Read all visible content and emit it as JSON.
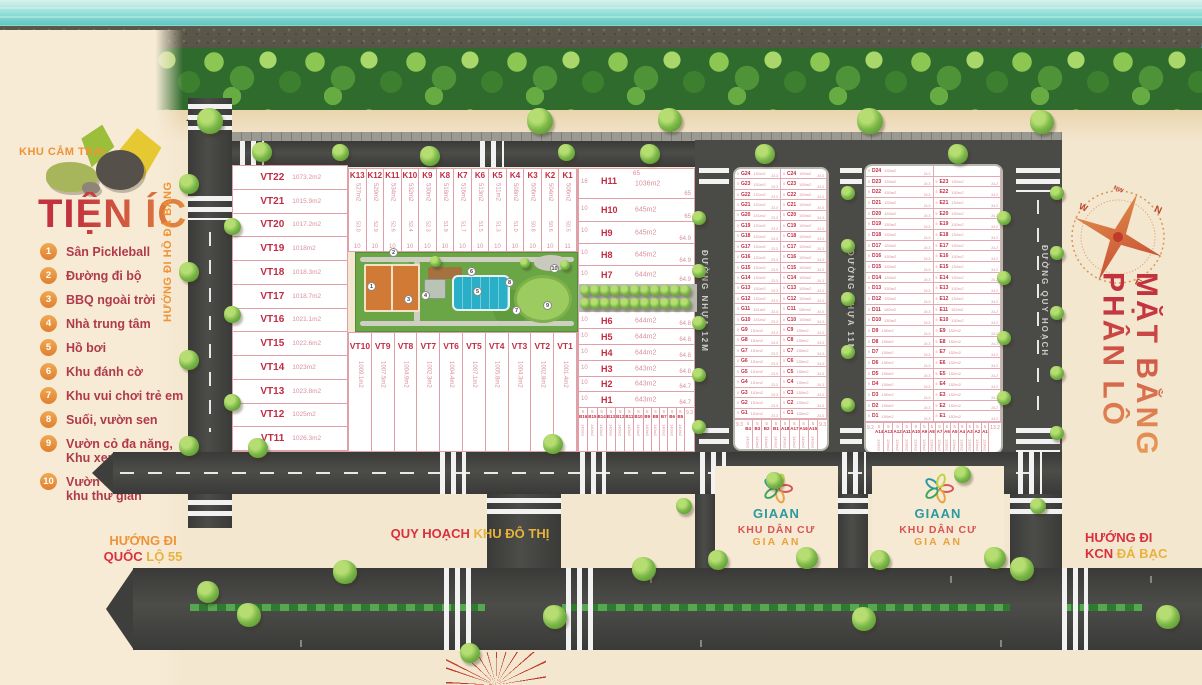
{
  "legend": {
    "camp": "KHU CẮM TRẠI",
    "heading": "TIỆN ÍCH",
    "items": [
      {
        "n": "1",
        "t": "Sân Pickleball"
      },
      {
        "n": "2",
        "t": "Đường đi bộ"
      },
      {
        "n": "3",
        "t": "BBQ ngoài trời"
      },
      {
        "n": "4",
        "t": "Nhà trung tâm"
      },
      {
        "n": "5",
        "t": "Hồ bơi"
      },
      {
        "n": "6",
        "t": "Khu đánh cờ"
      },
      {
        "n": "7",
        "t": "Khu vui chơi trẻ em"
      },
      {
        "n": "8",
        "t": "Suối, vườn sen"
      },
      {
        "n": "9",
        "t": "Vườn cỏ đa năng,\nKhu xem phim"
      },
      {
        "n": "10",
        "t": "Vườn cây ăn trái,\nkhu thư giãn"
      }
    ]
  },
  "title": {
    "line1": "MẶT BẰNG",
    "line2": "PHÂN LÔ"
  },
  "compass": {
    "n": "N",
    "nw": "NW",
    "w": "W",
    "e": "E"
  },
  "directions": {
    "ho_da_bang": "HƯỚNG ĐI HỒ ĐÁ BÀNG",
    "quoc_lo_1": "HƯỚNG ĐI",
    "quoc_lo_2a": "QUỐC",
    "quoc_lo_2b": "LỘ 55",
    "kcn_1": "HƯỚNG ĐI",
    "kcn_2a": "KCN",
    "kcn_2b": "ĐÁ BẠC",
    "khu_do_thi_a": "QUY HOẠCH",
    "khu_do_thi_b": "KHU ĐÔ THỊ"
  },
  "roads": {
    "nhua12": "ĐƯỜNG NHỰA 12M",
    "nhua11": "ĐƯỜNG NHỰA 11M",
    "quy_hoach": "ĐƯỜNG QUY HOẠCH"
  },
  "gia_an": {
    "brand": "GIAAN",
    "sub": "KHU DÂN CƯ",
    "name": "GIA AN"
  },
  "vt_left": [
    {
      "id": "VT22",
      "area": "1073.2m2"
    },
    {
      "id": "VT21",
      "area": "1015.9m2"
    },
    {
      "id": "VT20",
      "area": "1017.2m2"
    },
    {
      "id": "VT19",
      "area": "1018m2"
    },
    {
      "id": "VT18",
      "area": "1018.3m2"
    },
    {
      "id": "VT17",
      "area": "1018.7m2"
    },
    {
      "id": "VT16",
      "area": "1021.1m2"
    },
    {
      "id": "VT15",
      "area": "1022.6m2"
    },
    {
      "id": "VT14",
      "area": "1023m2"
    },
    {
      "id": "VT13",
      "area": "1023.8m2"
    },
    {
      "id": "VT12",
      "area": "1025m2"
    },
    {
      "id": "VT11",
      "area": "1026.3m2"
    }
  ],
  "k_row": [
    {
      "id": "K13",
      "area": "527m2",
      "len": "53.0",
      "w": "10"
    },
    {
      "id": "K12",
      "area": "529m2",
      "len": "52.9",
      "w": "10"
    },
    {
      "id": "K11",
      "area": "534m2",
      "len": "52.6",
      "w": "10"
    },
    {
      "id": "K10",
      "area": "532m2",
      "len": "52.4",
      "w": "10"
    },
    {
      "id": "K9",
      "area": "530m2",
      "len": "52.3",
      "w": "10"
    },
    {
      "id": "K8",
      "area": "518m2",
      "len": "51.9",
      "w": "10"
    },
    {
      "id": "K7",
      "area": "516m2",
      "len": "51.7",
      "w": "10"
    },
    {
      "id": "K6",
      "area": "513m2",
      "len": "51.5",
      "w": "10"
    },
    {
      "id": "K5",
      "area": "511m2",
      "len": "51.3",
      "w": "10"
    },
    {
      "id": "K4",
      "area": "508m2",
      "len": "51.0",
      "w": "10"
    },
    {
      "id": "K3",
      "area": "506m2",
      "len": "50.8",
      "w": "10"
    },
    {
      "id": "K2",
      "area": "504m2",
      "len": "50.6",
      "w": "10"
    },
    {
      "id": "K1",
      "area": "506m2",
      "len": "50.5",
      "w": "11"
    }
  ],
  "vt_bottom": [
    {
      "id": "VT10",
      "area": "1009.1m2"
    },
    {
      "id": "VT9",
      "area": "1007.5m2"
    },
    {
      "id": "VT8",
      "area": "1004.9m2"
    },
    {
      "id": "VT7",
      "area": "1002.3m2"
    },
    {
      "id": "VT6",
      "area": "1004.4m2"
    },
    {
      "id": "VT5",
      "area": "1007.1m2"
    },
    {
      "id": "VT4",
      "area": "1005.8m2"
    },
    {
      "id": "VT3",
      "area": "1004.3m2"
    },
    {
      "id": "VT2",
      "area": "1002.8m2"
    },
    {
      "id": "VT1",
      "area": "1001.4m2"
    }
  ],
  "h_block": {
    "top_len": "65",
    "rows": [
      {
        "id": "H11",
        "w": "16",
        "area": "1036m2",
        "len": "65"
      },
      {
        "id": "H10",
        "w": "10",
        "area": "645m2",
        "len": "65"
      },
      {
        "id": "H9",
        "w": "10",
        "area": "645m2",
        "len": "64.9"
      },
      {
        "id": "H8",
        "w": "10",
        "area": "645m2",
        "len": "64.9"
      },
      {
        "id": "H7",
        "w": "10",
        "area": "644m2",
        "len": "64.9"
      },
      {
        "id": "H6",
        "w": "10",
        "area": "644m2",
        "len": "64.8"
      },
      {
        "id": "H5",
        "w": "10",
        "area": "644m2",
        "len": "64.8"
      },
      {
        "id": "H4",
        "w": "10",
        "area": "644m2",
        "len": "64.8"
      },
      {
        "id": "H3",
        "w": "10",
        "area": "643m2",
        "len": "64.8"
      },
      {
        "id": "H2",
        "w": "10",
        "area": "643m2",
        "len": "64.7"
      },
      {
        "id": "H1",
        "w": "10",
        "area": "643m2",
        "len": "64.7"
      }
    ]
  },
  "b_row": {
    "right_edge": "9.3",
    "cells": [
      {
        "id": "B16",
        "w": "5",
        "area": "140m2"
      },
      {
        "id": "B15",
        "w": "5",
        "area": "140m2"
      },
      {
        "id": "B14",
        "w": "5",
        "area": "140m2"
      },
      {
        "id": "B13",
        "w": "5",
        "area": "140m2"
      },
      {
        "id": "B12",
        "w": "5",
        "area": "140m2"
      },
      {
        "id": "B11",
        "w": "5",
        "area": "140m2"
      },
      {
        "id": "B10",
        "w": "5",
        "area": "140m2"
      },
      {
        "id": "B9",
        "w": "5",
        "area": "140m2"
      },
      {
        "id": "B8",
        "w": "5",
        "area": "140m2"
      },
      {
        "id": "B7",
        "w": "5",
        "area": "140m2"
      },
      {
        "id": "B6",
        "w": "5",
        "area": "140m2"
      },
      {
        "id": "B5",
        "w": "5",
        "area": "140m2"
      }
    ]
  },
  "grid1": {
    "left": {
      "prefix": "G",
      "count": 24,
      "w": "5",
      "area": "151m2",
      "len": "23.3"
    },
    "right": {
      "prefix": "C",
      "count": 24,
      "w": "5",
      "area": "150m2",
      "len": "24.3"
    },
    "bottom": {
      "edge_l": "9.3",
      "edge_r": "9.3",
      "w": "5",
      "area": "140m2",
      "ids": [
        "B4",
        "B3",
        "B2",
        "B1",
        "A18",
        "A17",
        "A16",
        "A15"
      ]
    }
  },
  "grid2": {
    "left": {
      "prefix": "D",
      "count": 24,
      "w": "5",
      "area": "150m2",
      "len": "24.3"
    },
    "right": {
      "prefix": "E",
      "count": 23,
      "w": "5",
      "area": "152m2",
      "len": "24.2"
    },
    "bottom": {
      "edge_l": "9.2",
      "edge_r": "13.2",
      "w": "5",
      "area": "139m2",
      "ids": [
        "A14",
        "A13",
        "A12",
        "A11",
        "A10",
        "A9",
        "A8",
        "A7",
        "A6",
        "A5",
        "A4",
        "A3",
        "A2",
        "A1"
      ]
    }
  },
  "park_markers": [
    "1",
    "2",
    "3",
    "4",
    "5",
    "6",
    "7",
    "8",
    "9",
    "10"
  ]
}
